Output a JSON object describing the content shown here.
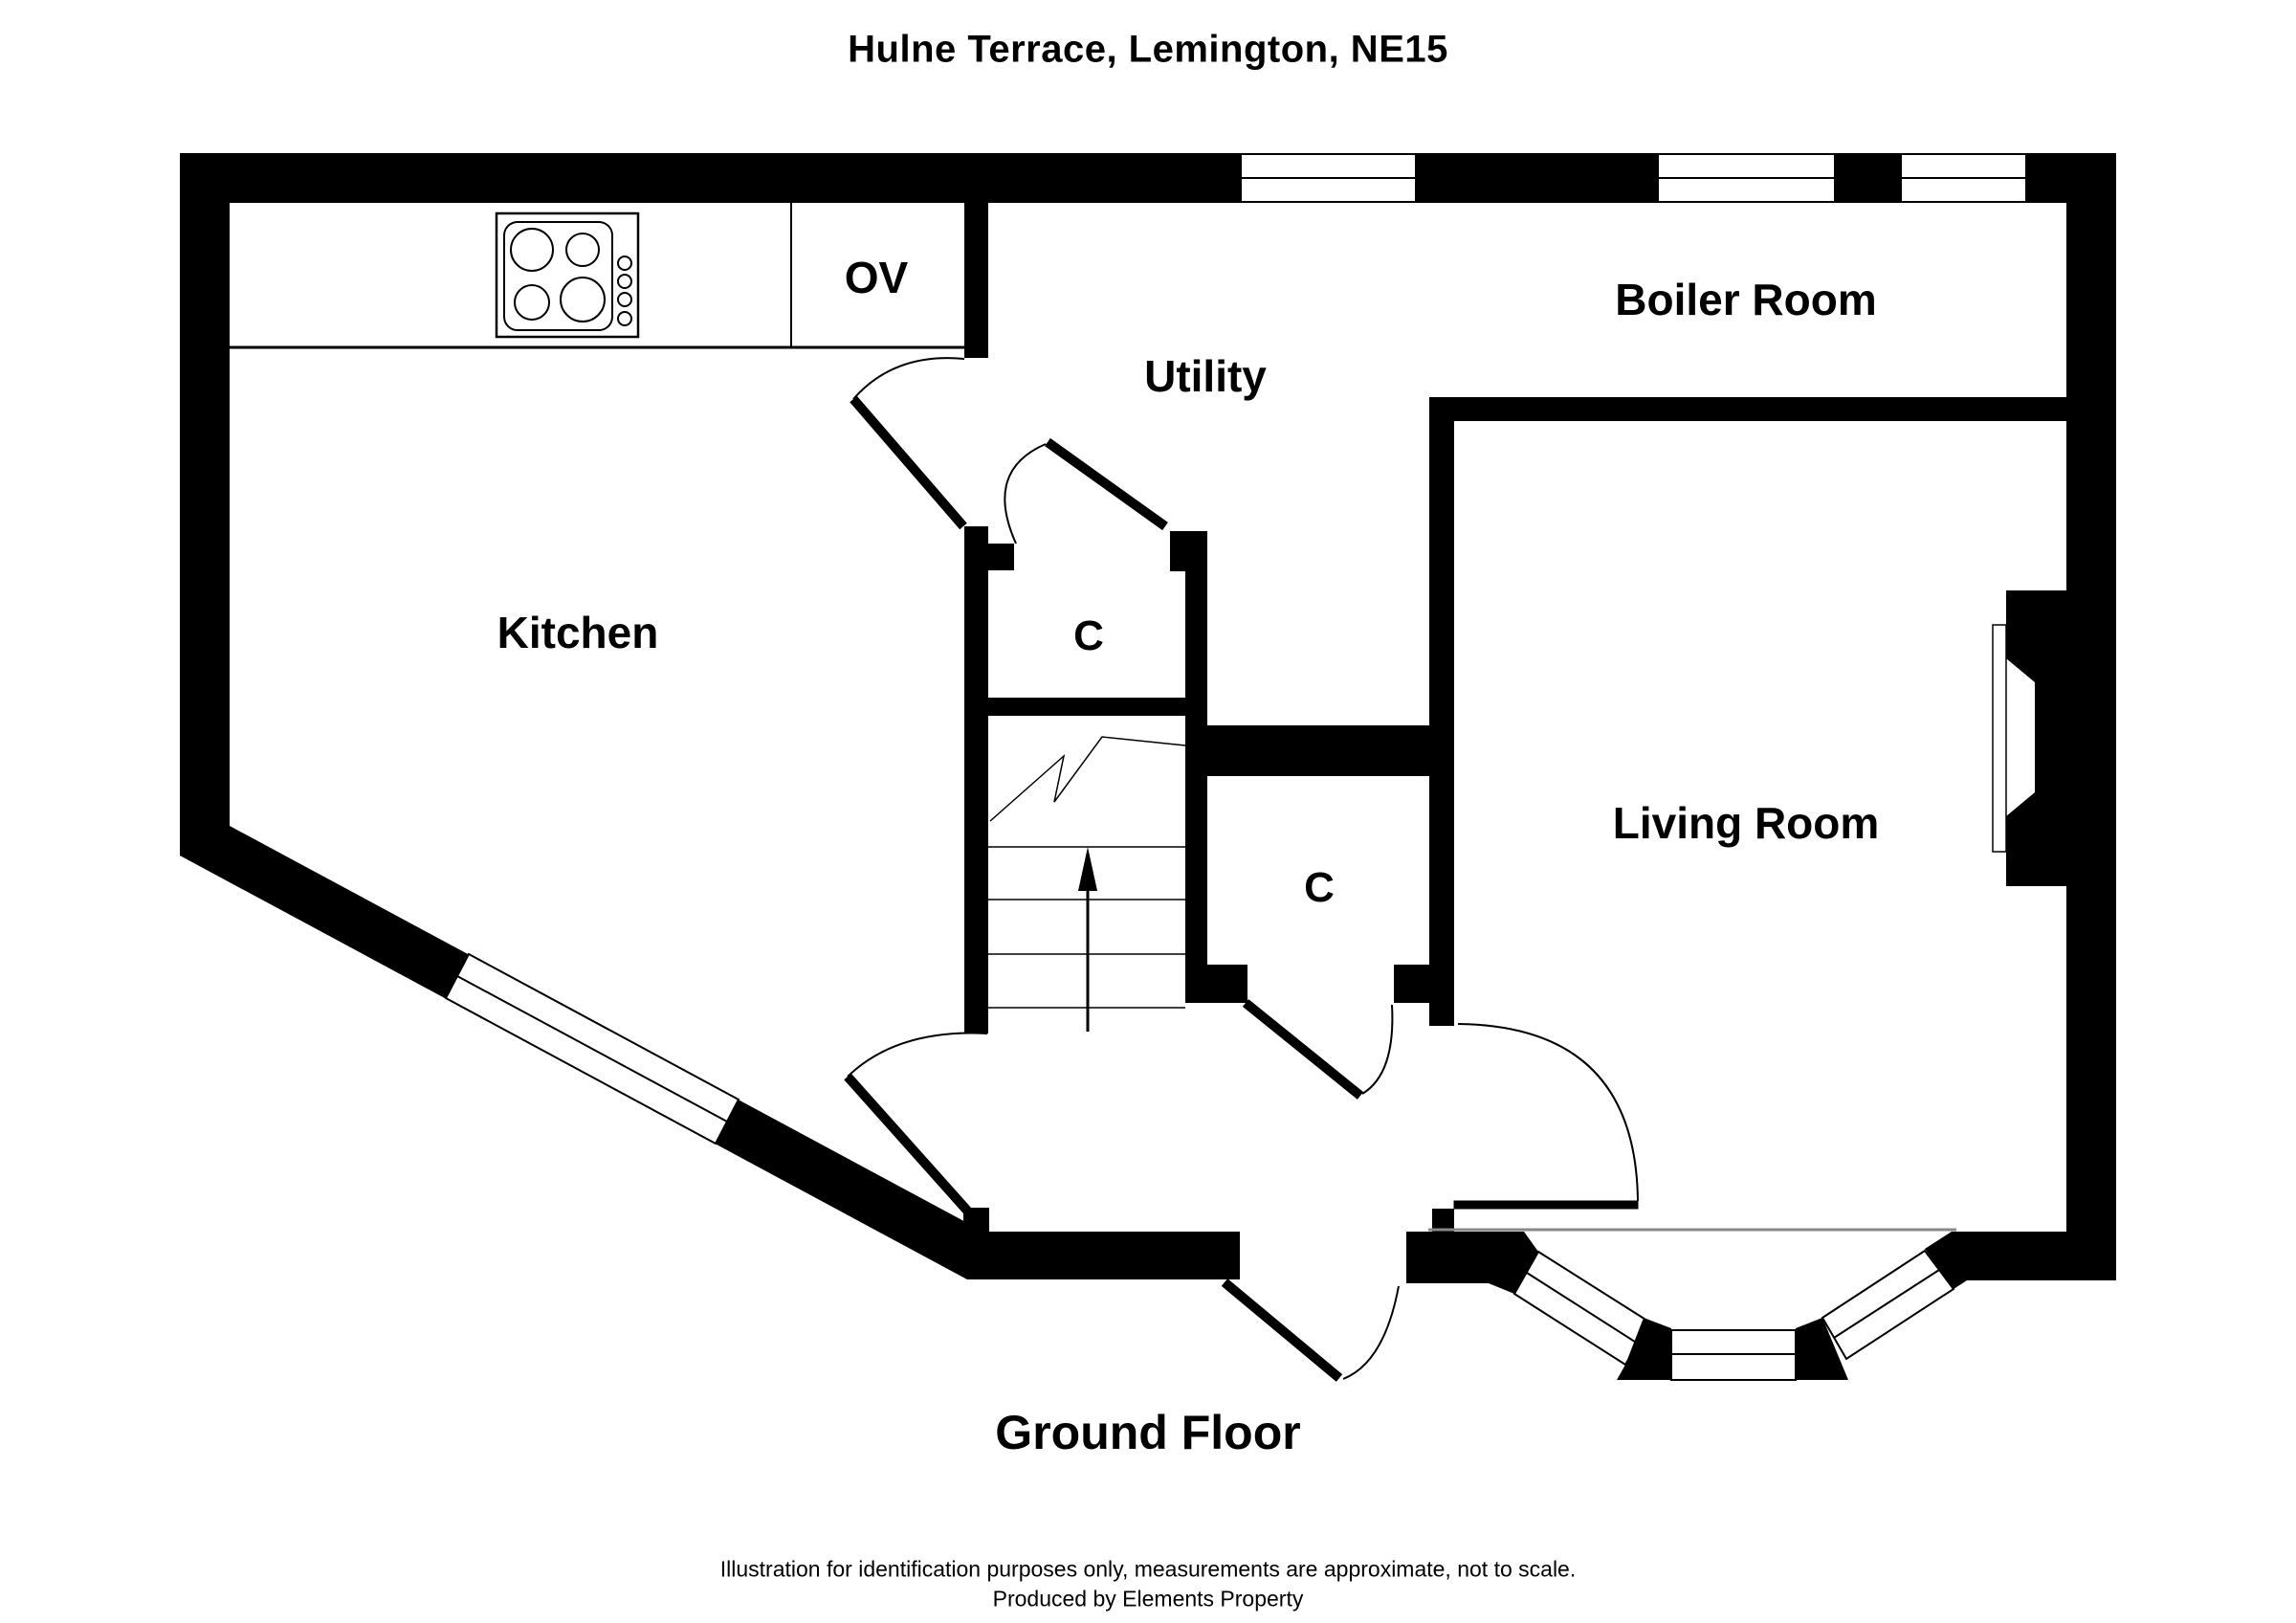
{
  "title": "Hulne Terrace, Lemington, NE15",
  "rooms": {
    "kitchen": "Kitchen",
    "utility": "Utility",
    "boiler_room": "Boiler Room",
    "living_room": "Living Room",
    "closet_top": "C",
    "closet_bottom": "C",
    "oven": "OV"
  },
  "floor_label": "Ground Floor",
  "footer": {
    "line1": "Illustration for identification purposes only, measurements are approximate, not to scale.",
    "line2": "Produced by Elements Property"
  },
  "colors": {
    "wall": "#000000",
    "background": "#ffffff",
    "thin_line": "#555555",
    "bay_opening_line": "#888888"
  },
  "icons": [
    "stove-hob-icon",
    "stairs-up-arrow-icon",
    "door-swing-arc",
    "window-glazing"
  ]
}
